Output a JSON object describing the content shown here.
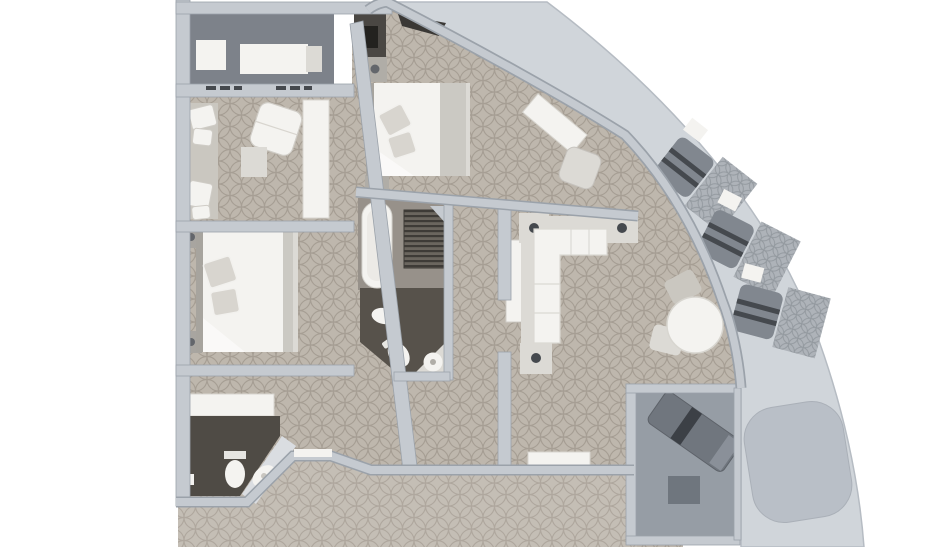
{
  "plan": {
    "type": "suite-floor-plan",
    "rooms": [
      {
        "name": "private-balcony-top",
        "furniture": [
          "side-table",
          "sun-lounger"
        ]
      },
      {
        "name": "sitting-room",
        "furniture": [
          "wall-sofa",
          "armchair",
          "side-table",
          "console-desk"
        ]
      },
      {
        "name": "bedroom-two",
        "furniture": [
          "double-bed",
          "nightstand",
          "nightstand"
        ]
      },
      {
        "name": "master-bedroom",
        "furniture": [
          "double-bed",
          "nightstand",
          "nightstand",
          "vanity-desk",
          "desk-chair"
        ]
      },
      {
        "name": "master-bathroom",
        "furniture": [
          "bathtub",
          "slatted-shower",
          "bidet",
          "toilet",
          "corner-sink"
        ]
      },
      {
        "name": "entry-hall",
        "furniture": [
          "wardrobe-counter",
          "entry-door"
        ]
      },
      {
        "name": "guest-bathroom",
        "furniture": [
          "toilet",
          "corner-sink",
          "paper-holder"
        ]
      },
      {
        "name": "living-room",
        "furniture": [
          "l-shaped-sofa",
          "end-table",
          "end-table",
          "end-table",
          "wardrobe",
          "dining-table",
          "dining-chair",
          "dining-chair",
          "sideboard"
        ]
      },
      {
        "name": "balcony-room",
        "furniture": [
          "sun-lounger",
          "side-table"
        ]
      },
      {
        "name": "curved-deck",
        "furniture": [
          "deck-chair-set",
          "deck-chair-set",
          "deck-chair-set",
          "spa-pad"
        ]
      },
      {
        "name": "corridor",
        "furniture": []
      }
    ]
  },
  "colors": {
    "background": "#ffffff",
    "wall": "#c5cad0",
    "wall_edge": "#9ba2aa",
    "wall_light": "#dadde1",
    "carpet_base": "#beb7ad",
    "carpet_line": "#968e83",
    "deck": "#d0d5da",
    "deck_edge": "#b6bcc3",
    "deck_pat_base": "#aeb3b9",
    "deck_pat_line": "#8c9298",
    "dark_floor": "#57524b",
    "guest_floor": "#4f4b45",
    "balcony_top_floor": "#7d828a",
    "balcony_room_floor": "#969da5",
    "bath_floor_light": "#97918a",
    "furniture_white": "#f4f3f0",
    "furniture_light": "#dcdad5",
    "furniture_tan": "#cac7c0",
    "bed_band": "#cbc9c3",
    "pillow": "#d8d5cf",
    "headboard": "#a7a49e",
    "dark_furniture": "#81878f",
    "dark_stripe": "#45494e",
    "lounger_dark": "#70767e",
    "lounger_stripe": "#3c4046",
    "spa": "#b9bfc7",
    "black_box": "#23221f",
    "dark_notch": "#3a3835",
    "shadow_dark": "#3f4146",
    "knob": "#63666b",
    "slat_base": "#6b665f",
    "slat_line": "#3e3b37"
  }
}
